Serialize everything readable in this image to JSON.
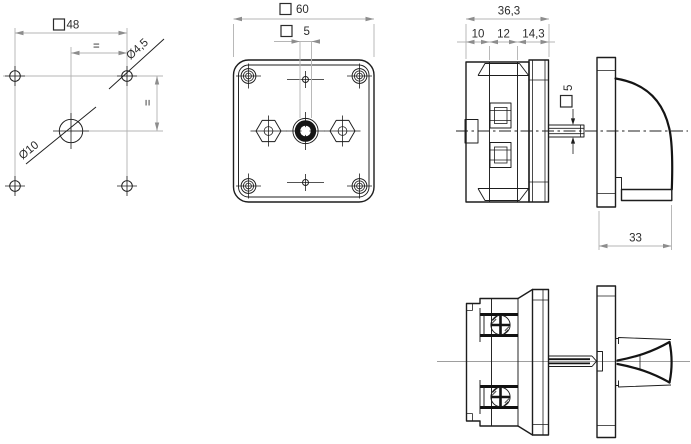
{
  "page": {
    "type": "technical-drawing",
    "background": "#ffffff"
  },
  "colors": {
    "outline": "#1d1d1d",
    "construction": "#b5b5b5",
    "centerline_gray": "#9e9e9e",
    "text": "#2b2b2b",
    "arrow": "#8d8d8d"
  },
  "views": {
    "drill_plan": {
      "label": "drilling-plan",
      "dims": {
        "square_width": "48",
        "equal_spacing_top": "=",
        "equal_spacing_right": "=",
        "mounting_hole_dia": "Ø4,5",
        "center_hole_dia": "Ø10"
      }
    },
    "front": {
      "label": "front-view",
      "dims": {
        "body_square": "60",
        "shaft_square": "5"
      }
    },
    "side": {
      "label": "side-view",
      "dims": {
        "depth_total": "36,3",
        "depth_rear": "10",
        "depth_mid": "12",
        "depth_front": "14,3",
        "shaft_square": "5",
        "handle_length": "33"
      }
    },
    "bottom": {
      "label": "bottom-view",
      "dims": {}
    }
  }
}
